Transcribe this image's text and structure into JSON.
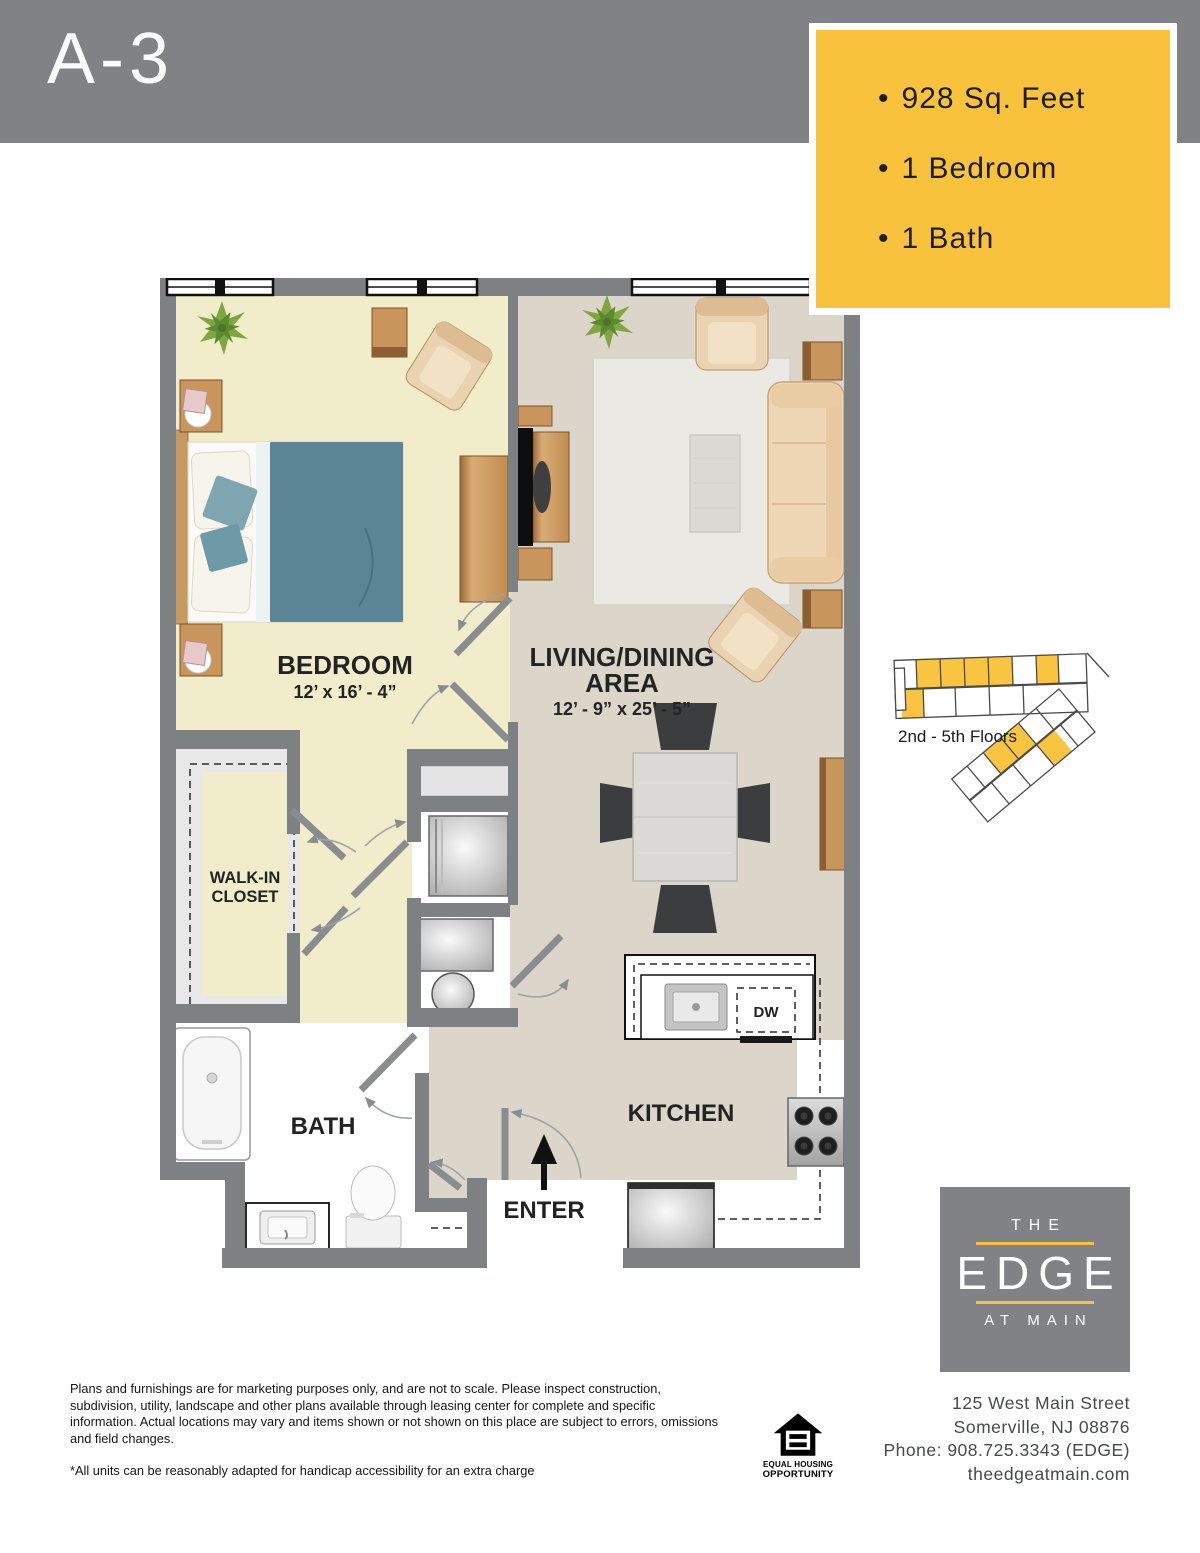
{
  "header": {
    "title": "A-3"
  },
  "specs": {
    "bullet": "•",
    "items": [
      "928 Sq. Feet",
      "1 Bedroom",
      "1 Bath"
    ]
  },
  "floorplan": {
    "bedroom": {
      "name": "BEDROOM",
      "dims": "12’ x 16’ - 4”"
    },
    "living": {
      "name_line1": "LIVING/DINING",
      "name_line2": "AREA",
      "dims": "12’ - 9” x 25’ - 5”"
    },
    "closet": {
      "line1": "WALK-IN",
      "line2": "CLOSET"
    },
    "bath": {
      "name": "BATH"
    },
    "kitchen": {
      "name": "KITCHEN"
    },
    "entry": {
      "name": "ENTER"
    },
    "dishwasher": "DW"
  },
  "siteplan": {
    "caption": "2nd - 5th Floors"
  },
  "logo": {
    "line1": "THE",
    "line2": "EDGE",
    "line3": "AT MAIN"
  },
  "contact": {
    "address_line1": "125 West Main Street",
    "address_line2": "Somerville, NJ 08876",
    "phone": "Phone: 908.725.3343 (EDGE)",
    "website": "theedgeatmain.com"
  },
  "disclaimer": {
    "paragraph": "Plans and furnishings are for marketing purposes only, and are not to scale. Please inspect construction, subdivision, utility, landscape and other plans available through leasing center for complete and specific information. Actual locations may vary and items shown or not shown on this place are subject to errors, omissions and field changes.",
    "note": "*All units can be reasonably adapted for handicap accessibility for an extra charge"
  },
  "eho": {
    "line1": "EQUAL HOUSING",
    "line2": "OPPORTUNITY"
  },
  "colors": {
    "accent_yellow": "#F9C23C",
    "band_gray": "#808285",
    "wall_gray": "#7E8184",
    "bedroom_floor": "#F1EDCB",
    "living_floor": "#DBD5CA",
    "text_dark": "#231F20"
  }
}
